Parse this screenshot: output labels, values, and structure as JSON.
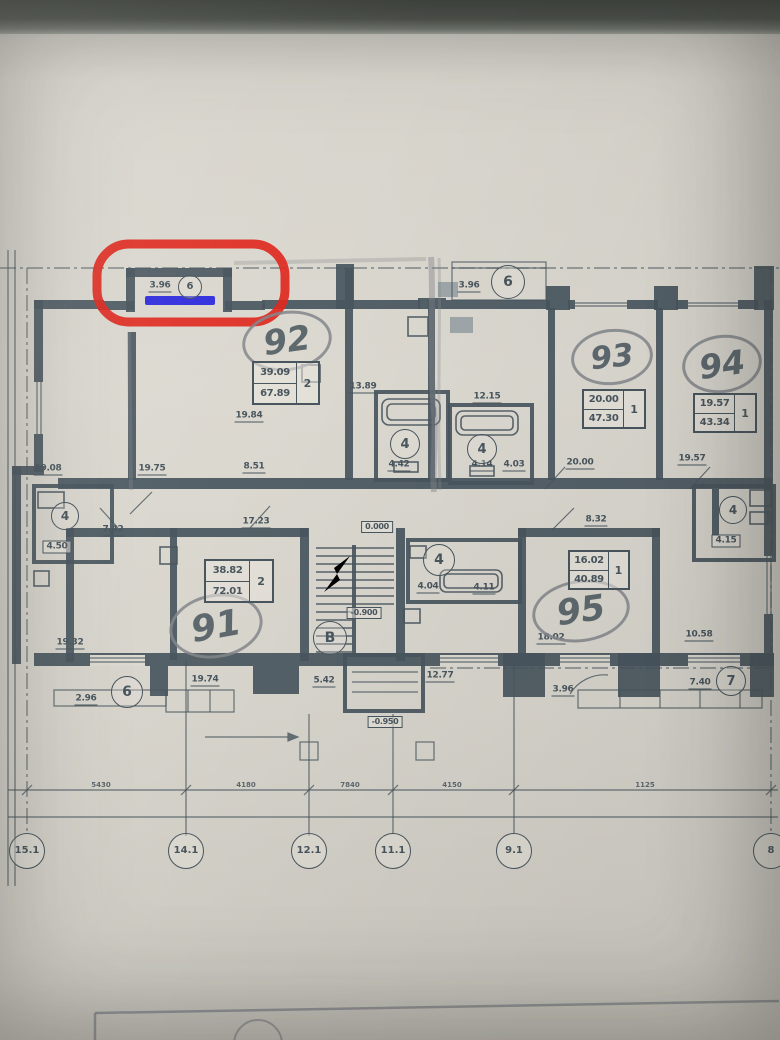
{
  "plan": {
    "ink_color": "#49565e",
    "pencil_color": "#84878c",
    "paper_color": "#dcd9d1"
  },
  "annotations": {
    "red_box": {
      "color": "#e0281e"
    },
    "blue_line": {
      "color": "#2b28dd"
    }
  },
  "apartments": [
    {
      "number": "92",
      "living_area": "39.09",
      "total_area": "67.89",
      "rooms": "2",
      "oval": {
        "x": 287,
        "y": 341,
        "rx": 42,
        "ry": 27,
        "rot": -8
      },
      "table": {
        "x": 254,
        "y": 363,
        "w": 64,
        "h": 40
      }
    },
    {
      "number": "93",
      "living_area": "20.00",
      "total_area": "47.30",
      "rooms": "1",
      "oval": {
        "x": 612,
        "y": 357,
        "rx": 38,
        "ry": 25,
        "rot": -6
      },
      "table": {
        "x": 584,
        "y": 391,
        "w": 60,
        "h": 36
      }
    },
    {
      "number": "94",
      "living_area": "19.57",
      "total_area": "43.34",
      "rooms": "1",
      "oval": {
        "x": 722,
        "y": 364,
        "rx": 37,
        "ry": 26,
        "rot": -8
      },
      "table": {
        "x": 695,
        "y": 395,
        "w": 60,
        "h": 36
      }
    },
    {
      "number": "91",
      "living_area": "38.82",
      "total_area": "72.01",
      "rooms": "2",
      "oval": {
        "x": 216,
        "y": 626,
        "rx": 44,
        "ry": 29,
        "rot": -10
      },
      "table": {
        "x": 206,
        "y": 561,
        "w": 66,
        "h": 40
      }
    },
    {
      "number": "95",
      "living_area": "16.02",
      "total_area": "40.89",
      "rooms": "1",
      "oval": {
        "x": 581,
        "y": 611,
        "rx": 46,
        "ry": 28,
        "rot": -8
      },
      "table": {
        "x": 570,
        "y": 552,
        "w": 58,
        "h": 36
      }
    }
  ],
  "dimension_labels": [
    {
      "t": "3.96",
      "x": 160,
      "y": 287
    },
    {
      "t": "3.96",
      "x": 469,
      "y": 287
    },
    {
      "t": "19.08",
      "x": 48,
      "y": 470
    },
    {
      "t": "19.75",
      "x": 152,
      "y": 470
    },
    {
      "t": "8.51",
      "x": 254,
      "y": 468
    },
    {
      "t": "13.89",
      "x": 363,
      "y": 388
    },
    {
      "t": "19.84",
      "x": 249,
      "y": 417
    },
    {
      "t": "4.42",
      "x": 399,
      "y": 466
    },
    {
      "t": "4.14",
      "x": 482,
      "y": 466
    },
    {
      "t": "4.03",
      "x": 514,
      "y": 466
    },
    {
      "t": "12.15",
      "x": 487,
      "y": 398
    },
    {
      "t": "20.00",
      "x": 580,
      "y": 464
    },
    {
      "t": "19.57",
      "x": 692,
      "y": 460
    },
    {
      "t": "7.42",
      "x": 113,
      "y": 531
    },
    {
      "t": "19.32",
      "x": 70,
      "y": 644
    },
    {
      "t": "17.23",
      "x": 256,
      "y": 523
    },
    {
      "t": "19.74",
      "x": 205,
      "y": 681
    },
    {
      "t": "5.42",
      "x": 324,
      "y": 682
    },
    {
      "t": "12.77",
      "x": 440,
      "y": 677
    },
    {
      "t": "4.04",
      "x": 428,
      "y": 588
    },
    {
      "t": "4.11",
      "x": 484,
      "y": 589
    },
    {
      "t": "8.32",
      "x": 596,
      "y": 521
    },
    {
      "t": "18.02",
      "x": 551,
      "y": 639
    },
    {
      "t": "10.58",
      "x": 699,
      "y": 636
    },
    {
      "t": "2.96",
      "x": 86,
      "y": 700
    },
    {
      "t": "3.96",
      "x": 563,
      "y": 691
    },
    {
      "t": "7.40",
      "x": 700,
      "y": 684
    },
    {
      "t": "4.50",
      "x": 57,
      "y": 547,
      "box": true
    },
    {
      "t": "4.15",
      "x": 726,
      "y": 541,
      "box": true
    }
  ],
  "level_marks": [
    {
      "t": "0.000",
      "x": 377,
      "y": 527
    },
    {
      "t": "-0.900",
      "x": 364,
      "y": 613
    },
    {
      "t": "-0.950",
      "x": 385,
      "y": 722
    }
  ],
  "circle_labels": [
    {
      "t": "6",
      "x": 190,
      "y": 287,
      "r": 11
    },
    {
      "t": "6",
      "x": 508,
      "y": 282,
      "r": 16
    },
    {
      "t": "6",
      "x": 127,
      "y": 692,
      "r": 15
    },
    {
      "t": "7",
      "x": 731,
      "y": 681,
      "r": 14
    },
    {
      "t": "В",
      "x": 330,
      "y": 638,
      "r": 16
    },
    {
      "t": "4",
      "x": 65,
      "y": 516,
      "r": 13
    },
    {
      "t": "4",
      "x": 405,
      "y": 444,
      "r": 14
    },
    {
      "t": "4",
      "x": 482,
      "y": 449,
      "r": 14
    },
    {
      "t": "4",
      "x": 439,
      "y": 560,
      "r": 15
    },
    {
      "t": "4",
      "x": 733,
      "y": 510,
      "r": 13
    }
  ],
  "grid_bubbles": {
    "y": 851,
    "r": 17,
    "items": [
      {
        "t": "15.1",
        "x": 27
      },
      {
        "t": "14.1",
        "x": 186
      },
      {
        "t": "12.1",
        "x": 309
      },
      {
        "t": "11.1",
        "x": 393
      },
      {
        "t": "9.1",
        "x": 514
      },
      {
        "t": "8",
        "x": 771
      }
    ]
  },
  "bottom_dimensions": {
    "y": 785,
    "items": [
      {
        "t": "5430",
        "x": 101
      },
      {
        "t": "4180",
        "x": 246
      },
      {
        "t": "7840",
        "x": 350
      },
      {
        "t": "4150",
        "x": 452
      },
      {
        "t": "1125",
        "x": 645
      }
    ]
  }
}
